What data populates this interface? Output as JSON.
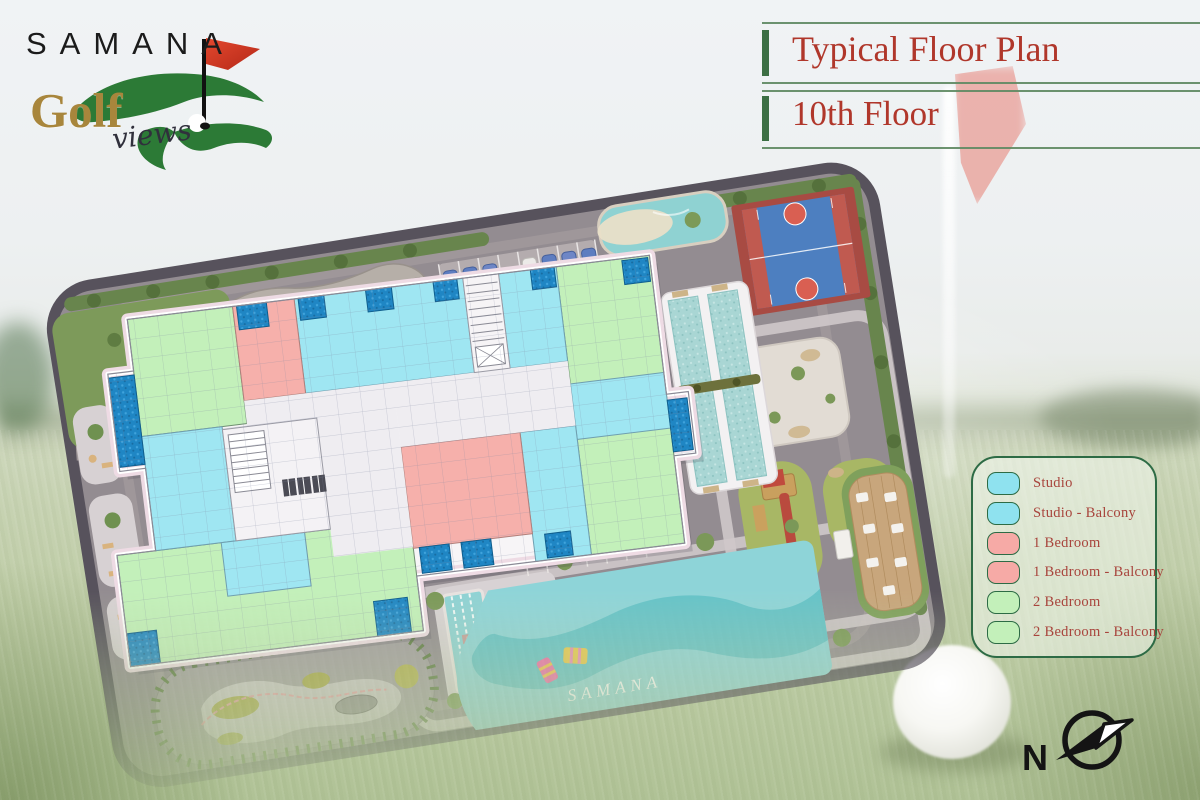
{
  "logo": {
    "brand": "SAMANA",
    "word": "Golf",
    "script": "views"
  },
  "header": {
    "title": "Typical Floor Plan",
    "subtitle": "10th Floor"
  },
  "legend": {
    "items": [
      {
        "label": "Studio",
        "color": "#8fe2ef"
      },
      {
        "label": "Studio - Balcony",
        "color": "#8fe2ef"
      },
      {
        "label": "1 Bedroom",
        "color": "#f6aaa6"
      },
      {
        "label": "1 Bedroom - Balcony",
        "color": "#f6aaa6"
      },
      {
        "label": "2 Bedroom",
        "color": "#c3f0ba"
      },
      {
        "label": "2 Bedroom - Balcony",
        "color": "#c3f0ba"
      }
    ]
  },
  "site_plan": {
    "pool_watermark": "SAMANA",
    "compass_label": "N"
  },
  "colors": {
    "title_red": "#b0372b",
    "divider_green": "#5f8a63",
    "legend_border": "#2d6b45",
    "studio_fill": "#9fe6f2",
    "one_bedroom_fill": "#f6b0ab",
    "two_bedroom_fill": "#c3f0ba",
    "plunge_pool_blue": "#1f86c4",
    "lagoon_teal": "#8ed4d8",
    "site_ground_gray": "#938c91",
    "hedge_green": "#68854d"
  }
}
